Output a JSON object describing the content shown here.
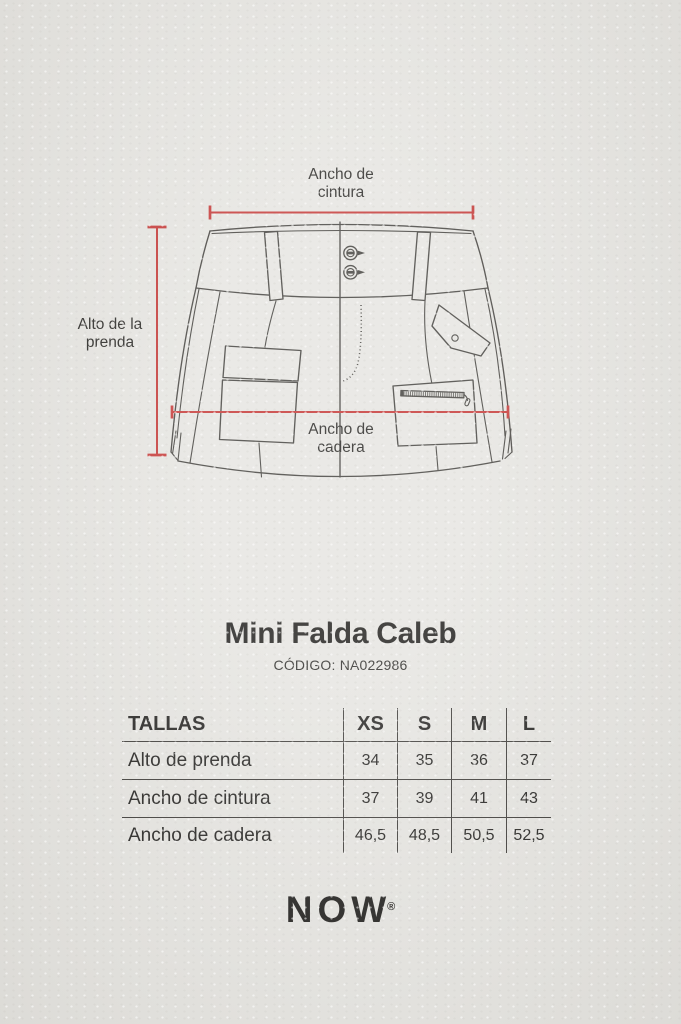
{
  "colors": {
    "paper": "#e5e4e0",
    "ink": "#21201e",
    "line": "#403e3a",
    "accent": "#c43432"
  },
  "diagram": {
    "waist_label": "Ancho de cintura",
    "height_label": "Alto de la prenda",
    "hip_label": "Ancho de cadera"
  },
  "product": {
    "title": "Mini Falda Caleb",
    "code": "CÓDIGO: NA022986"
  },
  "size_table": {
    "header": "TALLAS",
    "sizes": [
      "XS",
      "S",
      "M",
      "L"
    ],
    "rows": [
      {
        "label": "Alto de prenda",
        "values": [
          "34",
          "35",
          "36",
          "37"
        ]
      },
      {
        "label": "Ancho de cintura",
        "values": [
          "37",
          "39",
          "41",
          "43"
        ]
      },
      {
        "label": "Ancho de cadera",
        "values": [
          "46,5",
          "48,5",
          "50,5",
          "52,5"
        ]
      }
    ]
  },
  "brand": {
    "name": "NOW",
    "mark": "®"
  }
}
